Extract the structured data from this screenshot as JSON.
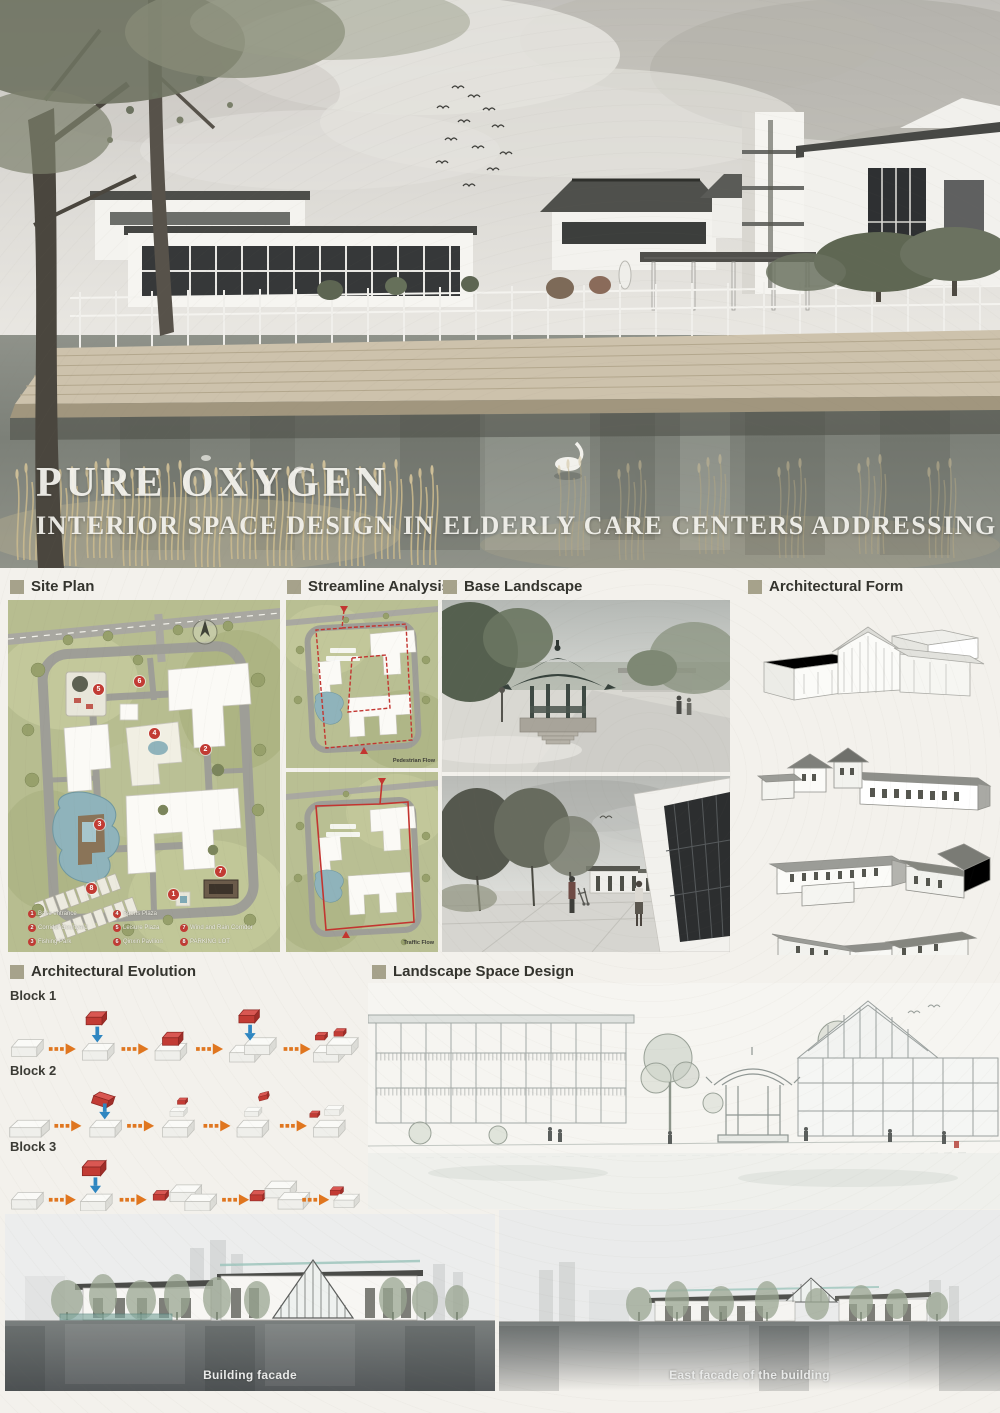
{
  "poster": {
    "title": "PURE OXYGEN",
    "subtitle": "INTERIOR SPACE DESIGN IN ELDERLY CARE CENTERS ADDRESSING"
  },
  "sections": {
    "site_plan": {
      "label": "Site Plan"
    },
    "streamline_analysis": {
      "label": "Streamline Analysis"
    },
    "base_landscape": {
      "label": "Base Landscape"
    },
    "architectural_form": {
      "label": "Architectural Form"
    },
    "architectural_evolution": {
      "label": "Architectural Evolution",
      "block_labels": [
        "Block 1",
        "Block 2",
        "Block 3"
      ]
    },
    "landscape_space_design": {
      "label": "Landscape Space Design"
    }
  },
  "site_plan_legend": [
    {
      "num": "1",
      "label": "Base entrance"
    },
    {
      "num": "2",
      "label": "Corridor Courtyard"
    },
    {
      "num": "3",
      "label": "Fishing Park"
    },
    {
      "num": "4",
      "label": "Sports Plaza"
    },
    {
      "num": "5",
      "label": "Leisure Plaza"
    },
    {
      "num": "6",
      "label": "Qinxin Pavilion"
    },
    {
      "num": "7",
      "label": "Wind and Rain Corridor"
    },
    {
      "num": "8",
      "label": "PARKING LOT"
    }
  ],
  "streamline_maps": [
    {
      "flow_label": "Pedestrian Flow"
    },
    {
      "flow_label": "Traffic Flow"
    }
  ],
  "elevations": {
    "left_caption": "Building facade",
    "right_caption": "East facade of the building"
  },
  "colors": {
    "accent_red": "#c23b34",
    "header_square": "#a6a28b",
    "arrow_orange": "#e0761f",
    "arrow_blue": "#2e86c1",
    "title_text": "#f5f4ef"
  }
}
